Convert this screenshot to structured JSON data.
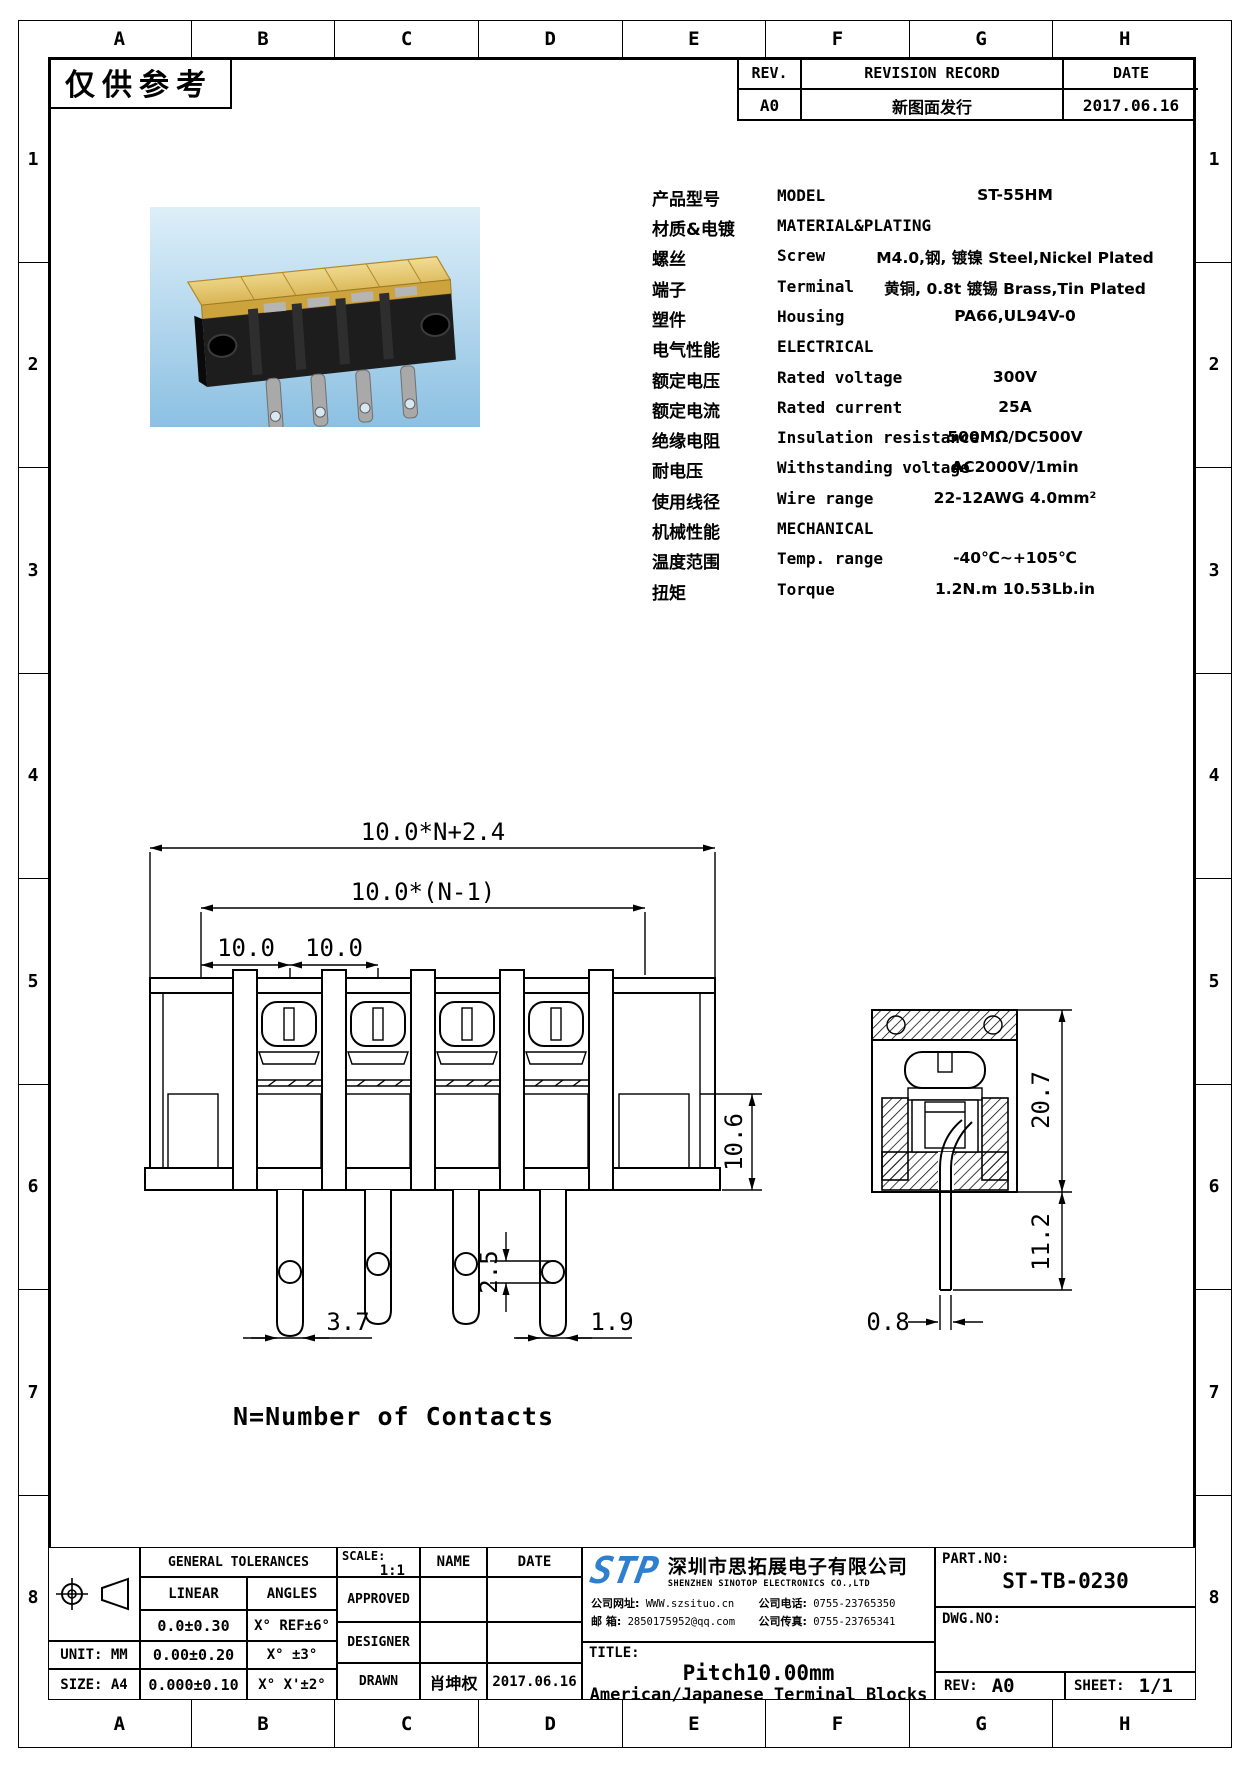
{
  "page": {
    "watermark": "仅供参考",
    "grid": {
      "columns": [
        "A",
        "B",
        "C",
        "D",
        "E",
        "F",
        "G",
        "H"
      ],
      "rows": [
        "1",
        "2",
        "3",
        "4",
        "5",
        "6",
        "7",
        "8"
      ]
    }
  },
  "revision_table": {
    "headers": [
      "REV.",
      "REVISION RECORD",
      "DATE"
    ],
    "row": {
      "rev": "A0",
      "record": "新图面发行",
      "date": "2017.06.16"
    }
  },
  "specs": {
    "rows": [
      {
        "cn": "产品型号",
        "en": "MODEL",
        "value": "ST-55HM"
      },
      {
        "cn": "材质&电镀",
        "en": "MATERIAL&PLATING",
        "value": ""
      },
      {
        "cn": "螺丝",
        "en": "Screw",
        "value": "M4.0,钢, 镀镍 Steel,Nickel Plated"
      },
      {
        "cn": "端子",
        "en": "Terminal",
        "value": "黄铜, 0.8t 镀锡 Brass,Tin Plated"
      },
      {
        "cn": "塑件",
        "en": "Housing",
        "value": "PA66,UL94V-0"
      },
      {
        "cn": "电气性能",
        "en": "ELECTRICAL",
        "value": ""
      },
      {
        "cn": "额定电压",
        "en": "Rated voltage",
        "value": "300V"
      },
      {
        "cn": "额定电流",
        "en": "Rated current",
        "value": "25A"
      },
      {
        "cn": "绝缘电阻",
        "en": "Insulation resistance",
        "value": "500MΩ/DC500V"
      },
      {
        "cn": "耐电压",
        "en": "Withstanding voltage",
        "value": "AC2000V/1min"
      },
      {
        "cn": "使用线径",
        "en": "Wire range",
        "value": "22-12AWG 4.0mm²"
      },
      {
        "cn": "机械性能",
        "en": "MECHANICAL",
        "value": ""
      },
      {
        "cn": "温度范围",
        "en": "Temp. range",
        "value": "-40℃~+105℃"
      },
      {
        "cn": "扭矩",
        "en": "Torque",
        "value": "1.2N.m  10.53Lb.in"
      }
    ]
  },
  "drawing": {
    "front": {
      "dim_total": "10.0*N+2.4",
      "dim_span": "10.0*(N-1)",
      "dim_pitch_a": "10.0",
      "dim_pitch_b": "10.0",
      "dim_height": "10.6",
      "dim_leg_width": "3.7",
      "dim_hole": "2.5",
      "dim_leg_thickness": "1.9"
    },
    "side": {
      "dim_height": "20.7",
      "dim_pin_length": "11.2",
      "dim_pin_thickness": "0.8"
    },
    "note": "N=Number of Contacts"
  },
  "title_block": {
    "tolerances": {
      "header": "GENERAL TOLERANCES",
      "linear_label": "LINEAR",
      "angles_label": "ANGLES",
      "linear": [
        "0.0±0.30",
        "0.00±0.20",
        "0.000±0.10"
      ],
      "angles": [
        "X° REF±6°",
        "X° ±3°",
        "X° X'±2°"
      ]
    },
    "unit": "UNIT: MM",
    "size": "SIZE: A4",
    "scale_label": "SCALE:",
    "scale_value": "1:1",
    "name_label": "NAME",
    "date_label": "DATE",
    "approved_label": "APPROVED",
    "designer_label": "DESIGNER",
    "drawn_label": "DRAWN",
    "drawn_name": "肖坤权",
    "drawn_date": "2017.06.16",
    "company": {
      "logo": "STP",
      "name_cn": "深圳市思拓展电子有限公司",
      "name_en": "SHENZHEN SINOTOP ELECTRONICS CO.,LTD",
      "website_label": "公司网址:",
      "website": "WWW.szsituo.cn",
      "phone_label": "公司电话:",
      "phone": "0755-23765350",
      "email_label": "邮  箱:",
      "email": "2850175952@qq.com",
      "fax_label": "公司传真:",
      "fax": "0755-23765341"
    },
    "title_label": "TITLE:",
    "title_line1": "Pitch10.00mm",
    "title_line2": "American/Japanese Terminal Blocks",
    "part_no_label": "PART.NO:",
    "part_no": "ST-TB-0230",
    "dwg_no_label": "DWG.NO:",
    "rev_label": "REV:",
    "rev_value": "A0",
    "sheet_label": "SHEET:",
    "sheet_value": "1/1"
  },
  "colors": {
    "logo_blue": "#2e7fd0",
    "photo_sky": "#8cc0e2",
    "cover_amber": "#e2bf63"
  }
}
